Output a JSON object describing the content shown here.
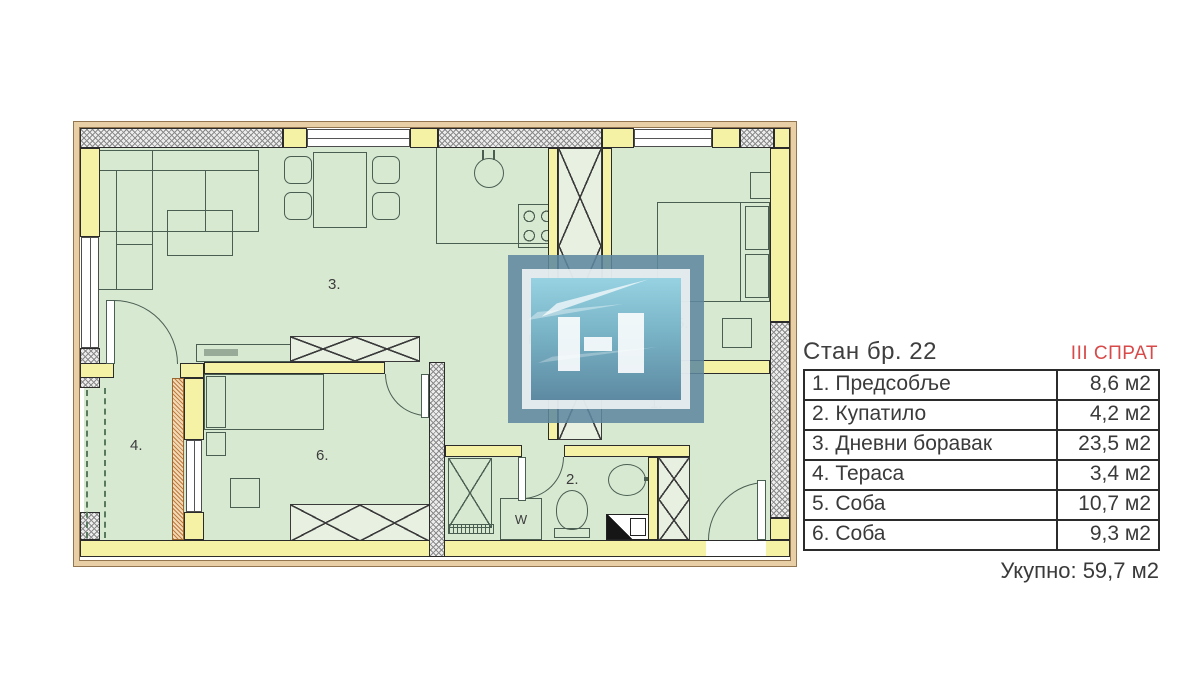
{
  "info": {
    "title": "Стан бр. 22",
    "floor": "III СПРАТ",
    "rooms": [
      {
        "name": "1. Предсобље",
        "area": "8,6 м2"
      },
      {
        "name": "2. Купатило",
        "area": "4,2 м2"
      },
      {
        "name": "3. Дневни боравак",
        "area": "23,5 м2"
      },
      {
        "name": "4. Тераса",
        "area": "3,4 м2"
      },
      {
        "name": "5. Соба",
        "area": "10,7 м2"
      },
      {
        "name": "6. Соба",
        "area": "9,3 м2"
      }
    ],
    "total": "Укупно: 59,7 м2"
  },
  "plan": {
    "labels": [
      {
        "text": "3."
      },
      {
        "text": "5."
      },
      {
        "text": "4."
      },
      {
        "text": "6."
      },
      {
        "text": "2."
      },
      {
        "text": "1."
      },
      {
        "text": "F"
      },
      {
        "text": "W"
      }
    ]
  },
  "colors": {
    "floor_green": "#d8e9d2",
    "wall_yellow": "#f6f2a5",
    "accent_red": "#d84a4a",
    "logo_blue": "#5e87a0"
  }
}
